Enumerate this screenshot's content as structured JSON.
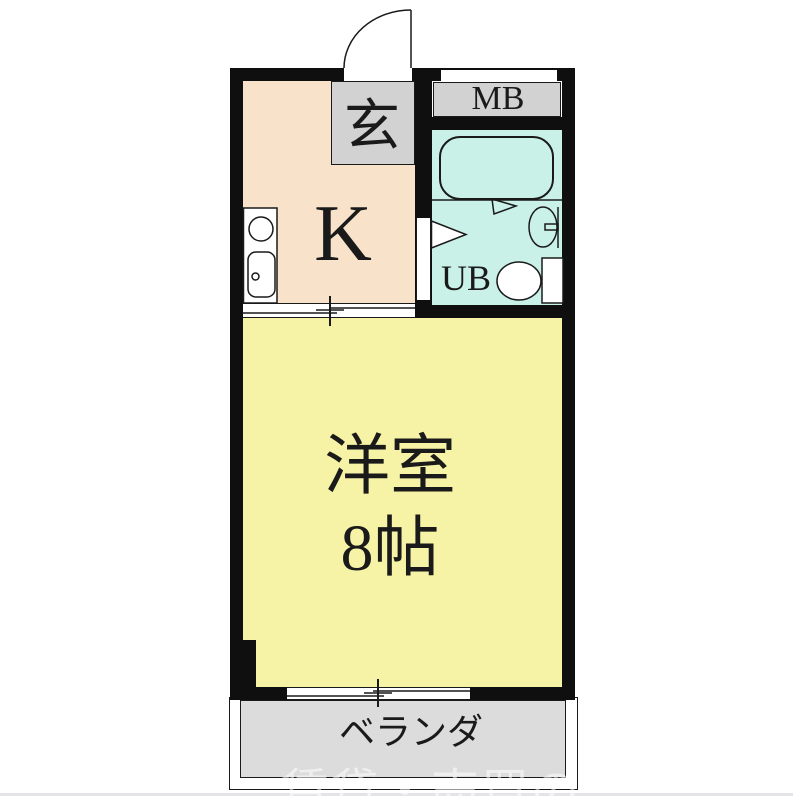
{
  "title": "apartment-floor-plan",
  "rooms": {
    "genkan": {
      "label": "玄"
    },
    "kitchen": {
      "label": "K"
    },
    "meter_box": {
      "label": "MB"
    },
    "unit_bath": {
      "label": "UB"
    },
    "main_room": {
      "name": "洋室",
      "size": "8帖"
    },
    "veranda": {
      "label": "ベランダ"
    }
  },
  "watermark": {
    "text": "賃貸・売買の"
  },
  "fixtures": [
    "entrance-door-swing",
    "kitchen-counter",
    "burner",
    "kitchen-sink",
    "sliding-door",
    "bathtub",
    "bath-partition",
    "ub-door",
    "washbasin",
    "toilet",
    "veranda-window"
  ],
  "colors": {
    "wall": "#0f0f0f",
    "line": "#1a1a1a",
    "text": "#1a1a1a",
    "kitchen": "#f8e3ca",
    "genkan": "#d2d2d2",
    "mb": "#d2d2d2",
    "bath": "#c9f1e7",
    "room": "#f7f3a6",
    "veranda": "#dcdcdc"
  }
}
